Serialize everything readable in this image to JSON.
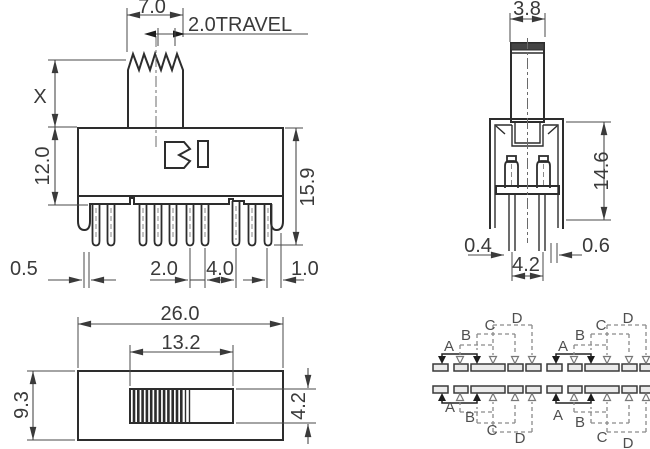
{
  "title": "Slide switch technical drawing",
  "front": {
    "knob_width": "7.0",
    "travel_label": "2.0TRAVEL",
    "stem_height_label": "X",
    "body_height": "12.0",
    "overall_height": "15.9",
    "pin_dim_a": "0.5",
    "pin_pitch": "2.0",
    "pin_gap": "4.0",
    "end_gap": "1.0"
  },
  "side": {
    "knob_thickness": "3.8",
    "body_height": "14.6",
    "leg_width": "0.4",
    "bracket_gap": "0.6",
    "leg_pitch": "4.2"
  },
  "top": {
    "body_length": "26.0",
    "slot_length": "13.2",
    "body_width": "9.3",
    "slot_width": "4.2"
  },
  "schematic": {
    "labels": {
      "a": "A",
      "b": "B",
      "c": "C",
      "d": "D"
    }
  },
  "colors": {
    "line": "#2d2d2d",
    "dimension": "#4a4a4a",
    "dashed": "#8a8a8a",
    "pad_fill": "#ebebeb"
  }
}
